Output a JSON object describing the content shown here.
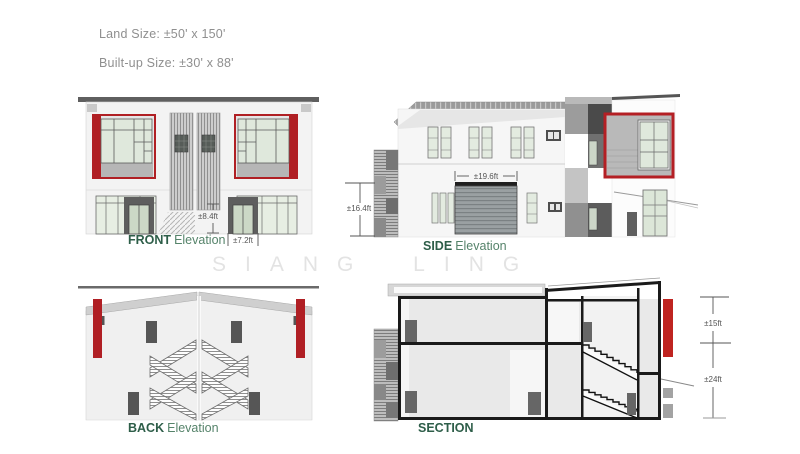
{
  "header": {
    "land_size": "Land Size: ±50' x 150'",
    "built_up_size": "Built-up Size: ±30' x 88'"
  },
  "watermark": "SIANG LING",
  "front": {
    "label_primary": "FRONT",
    "label_secondary": "Elevation",
    "dim_entrance_height": "±8.4ft",
    "dim_door_width": "±7.2ft"
  },
  "side": {
    "label_primary": "SIDE",
    "label_secondary": "Elevation",
    "dim_building_height": "±16.4ft",
    "dim_shutter_width": "±19.6ft"
  },
  "back": {
    "label_primary": "BACK",
    "label_secondary": "Elevation"
  },
  "section": {
    "label_primary": "SECTION",
    "dim_upper": "±15ft",
    "dim_lower": "±24ft"
  },
  "colors": {
    "accent_red": "#b01f24",
    "section_red": "#bf2420",
    "label_green_dark": "#2e5e49",
    "label_green": "#55836a",
    "glass_green": "#dfe8dc",
    "dim_text": "#555555",
    "watermark_gray": "#e3e3e3",
    "roof_gray": "#5f5f5f"
  }
}
